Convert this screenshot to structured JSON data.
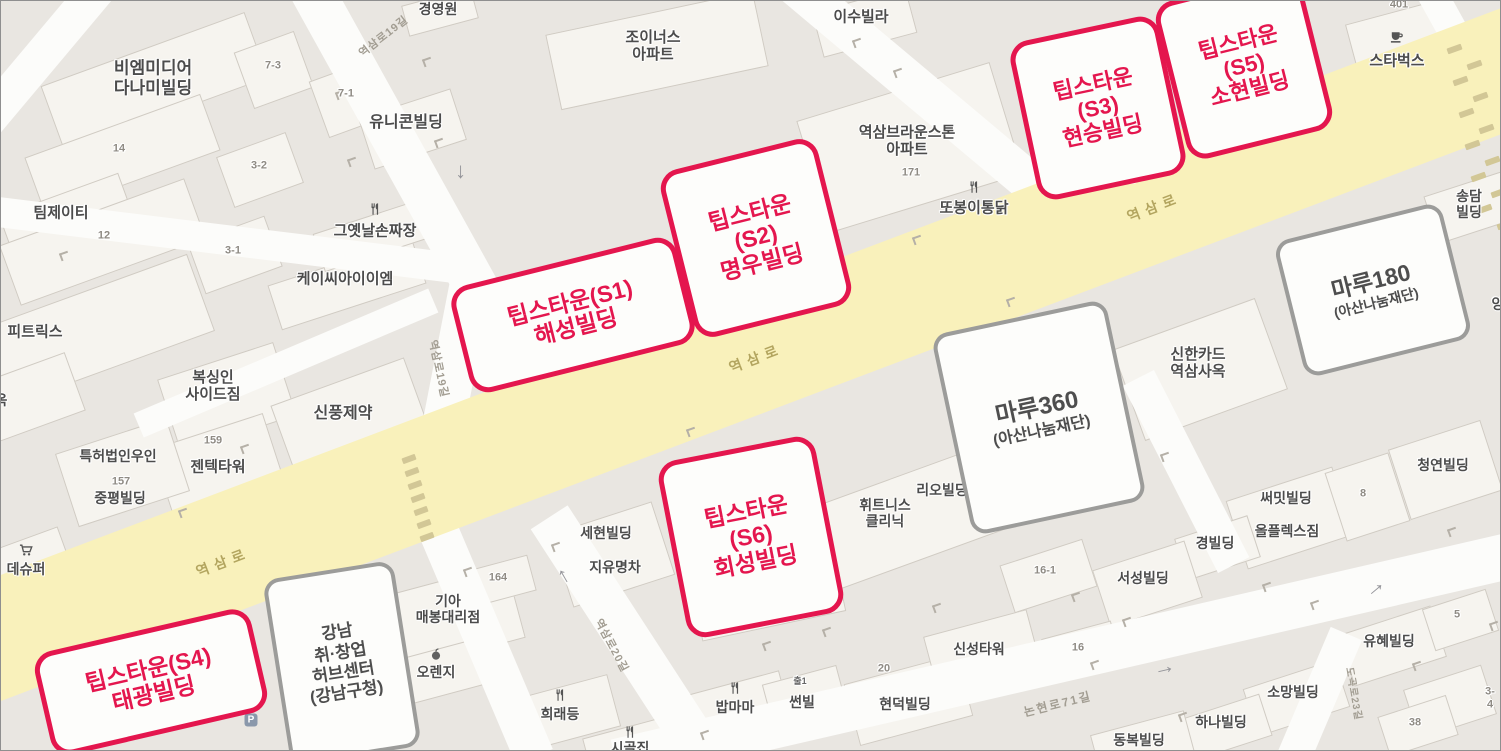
{
  "map": {
    "width": 1501,
    "height": 751,
    "colors": {
      "background": "#e9e6e1",
      "building": "#f6f4ef",
      "road_white": "#fcfcfa",
      "road_yellow": "#f9f1bb",
      "accent_red": "#e4164e",
      "callout_gray_border": "#9c9c9a",
      "label": "#4c4c4c",
      "number": "#8f8b84",
      "main_road_label": "#b3a55f",
      "street_label": "#a29d92"
    }
  },
  "main_road": {
    "x": 725,
    "y": 363,
    "len": 1760,
    "wid": 118,
    "rot": -20.7,
    "name": "yeoksam-ro"
  },
  "roads": [
    {
      "x": 392,
      "y": 137,
      "len": 345,
      "wid": 44,
      "rot": 61
    },
    {
      "x": 451,
      "y": 377,
      "len": 205,
      "wid": 42,
      "rot": 101
    },
    {
      "x": 40,
      "y": 55,
      "len": 175,
      "wid": 36,
      "rot": 130
    },
    {
      "x": 225,
      "y": 239,
      "len": 480,
      "wid": 30,
      "rot": 7
    },
    {
      "x": 285,
      "y": 362,
      "len": 320,
      "wid": 26,
      "rot": -23
    },
    {
      "x": 920,
      "y": 90,
      "len": 330,
      "wid": 40,
      "rot": 40
    },
    {
      "x": 628,
      "y": 640,
      "len": 295,
      "wid": 44,
      "rot": 57
    },
    {
      "x": 485,
      "y": 643,
      "len": 245,
      "wid": 40,
      "rot": 67
    },
    {
      "x": 1065,
      "y": 657,
      "len": 925,
      "wid": 46,
      "rot": -13
    },
    {
      "x": 1318,
      "y": 697,
      "len": 140,
      "wid": 34,
      "rot": 113
    },
    {
      "x": 1449,
      "y": 25,
      "len": 90,
      "wid": 30,
      "rot": 61
    },
    {
      "x": 1185,
      "y": 470,
      "len": 210,
      "wid": 35,
      "rot": 63
    }
  ],
  "buildings": [
    [
      152,
      80,
      215,
      68,
      -20
    ],
    [
      272,
      68,
      62,
      58,
      -20
    ],
    [
      347,
      97,
      62,
      58,
      -20
    ],
    [
      410,
      127,
      95,
      52,
      -18
    ],
    [
      120,
      152,
      185,
      58,
      -20
    ],
    [
      258,
      168,
      72,
      52,
      -20
    ],
    [
      64,
      214,
      125,
      45,
      -20
    ],
    [
      100,
      240,
      195,
      62,
      -20
    ],
    [
      233,
      253,
      80,
      52,
      -20
    ],
    [
      345,
      282,
      150,
      45,
      -18
    ],
    [
      372,
      233,
      115,
      38,
      -18
    ],
    [
      90,
      330,
      230,
      80,
      -20
    ],
    [
      30,
      395,
      90,
      60,
      -20
    ],
    [
      225,
      395,
      120,
      75,
      -18
    ],
    [
      218,
      470,
      115,
      85,
      -18
    ],
    [
      120,
      470,
      115,
      75,
      -18
    ],
    [
      350,
      420,
      140,
      85,
      -20
    ],
    [
      25,
      560,
      80,
      45,
      -20
    ],
    [
      655,
      48,
      210,
      75,
      -12
    ],
    [
      862,
      20,
      95,
      45,
      -15
    ],
    [
      908,
      145,
      200,
      115,
      -17
    ],
    [
      1398,
      42,
      95,
      65,
      -15
    ],
    [
      1470,
      205,
      85,
      48,
      -18
    ],
    [
      1198,
      367,
      150,
      95,
      -20
    ],
    [
      940,
      492,
      85,
      40,
      -20
    ],
    [
      895,
      520,
      200,
      85,
      -20
    ],
    [
      1443,
      468,
      95,
      72,
      -18
    ],
    [
      1288,
      516,
      110,
      70,
      -18
    ],
    [
      1215,
      546,
      75,
      42,
      -18
    ],
    [
      610,
      552,
      105,
      75,
      -18
    ],
    [
      450,
      615,
      130,
      75,
      -15
    ],
    [
      437,
      670,
      85,
      45,
      -15
    ],
    [
      560,
      712,
      105,
      52,
      -15
    ],
    [
      736,
      705,
      95,
      48,
      -15
    ],
    [
      803,
      697,
      75,
      48,
      -15
    ],
    [
      906,
      698,
      115,
      62,
      -15
    ],
    [
      980,
      650,
      105,
      58,
      -15
    ],
    [
      1145,
      582,
      95,
      58,
      -18
    ],
    [
      1046,
      574,
      85,
      48,
      -18
    ],
    [
      1390,
      644,
      95,
      52,
      -18
    ],
    [
      1294,
      696,
      95,
      48,
      -18
    ],
    [
      1222,
      726,
      85,
      42,
      -18
    ],
    [
      1140,
      742,
      95,
      42,
      -15
    ],
    [
      1458,
      618,
      65,
      42,
      -18
    ],
    [
      1365,
      495,
      65,
      70,
      -18
    ],
    [
      1448,
      700,
      80,
      50,
      -18
    ],
    [
      1416,
      724,
      70,
      40,
      -18
    ],
    [
      1080,
      650,
      70,
      45,
      -15
    ],
    [
      500,
      578,
      60,
      35,
      -15
    ],
    [
      755,
      545,
      145,
      160,
      -12
    ],
    [
      630,
      745,
      90,
      40,
      -15
    ],
    [
      438,
      10,
      70,
      30,
      -15
    ]
  ],
  "crosswalks": [
    {
      "x": 408,
      "y": 458,
      "count": 7,
      "dx": 3,
      "dy": 13,
      "w": 14,
      "h": 6,
      "rot": -20
    },
    {
      "x": 1453,
      "y": 48,
      "count": 12,
      "dx": 3,
      "dy": 16,
      "w": 15,
      "h": 6,
      "rot": -20,
      "stagger": 17
    }
  ],
  "entrance_marks": [
    [
      335,
      90
    ],
    [
      422,
      57
    ],
    [
      59,
      251
    ],
    [
      347,
      157
    ],
    [
      434,
      138
    ],
    [
      852,
      38
    ],
    [
      1032,
      47
    ],
    [
      893,
      68
    ],
    [
      240,
      444
    ],
    [
      178,
      508
    ],
    [
      463,
      567
    ],
    [
      551,
      542
    ],
    [
      762,
      641
    ],
    [
      822,
      627
    ],
    [
      932,
      603
    ],
    [
      1122,
      617
    ],
    [
      1071,
      592
    ],
    [
      1262,
      582
    ],
    [
      1412,
      661
    ],
    [
      1489,
      621
    ],
    [
      686,
      427
    ],
    [
      781,
      482
    ],
    [
      1160,
      452
    ],
    [
      1006,
      297
    ],
    [
      1447,
      527
    ],
    [
      912,
      235
    ],
    [
      1090,
      660
    ],
    [
      1310,
      600
    ],
    [
      700,
      730
    ],
    [
      1178,
      712
    ]
  ],
  "road_labels": [
    {
      "t": "역삼로",
      "x": 755,
      "y": 357,
      "rot": -21,
      "s": 14,
      "sp": 6,
      "c": "#b3a55f"
    },
    {
      "t": "역삼로",
      "x": 1153,
      "y": 206,
      "rot": -21,
      "s": 14,
      "sp": 6,
      "c": "#b3a55f"
    },
    {
      "t": "역삼로",
      "x": 222,
      "y": 561,
      "rot": -21,
      "s": 14,
      "sp": 6,
      "c": "#b3a55f"
    },
    {
      "t": "역삼로19길",
      "x": 383,
      "y": 36,
      "rot": -38,
      "s": 11,
      "sp": 1,
      "c": "#a29d92"
    },
    {
      "t": "역삼로19길",
      "x": 437,
      "y": 368,
      "rot": 78,
      "s": 11,
      "sp": 1,
      "c": "#a29d92"
    },
    {
      "t": "역삼로20길",
      "x": 610,
      "y": 645,
      "rot": 62,
      "s": 11,
      "sp": 1,
      "c": "#a29d92"
    },
    {
      "t": "논현로71길",
      "x": 1057,
      "y": 704,
      "rot": -14,
      "s": 12,
      "sp": 2,
      "c": "#a29d92"
    },
    {
      "t": "도곡로23길",
      "x": 1352,
      "y": 693,
      "rot": 80,
      "s": 10,
      "sp": 1,
      "c": "#a29d92"
    }
  ],
  "labels": [
    {
      "t": "비엠미디어\n다나미빌딩",
      "x": 152,
      "y": 77,
      "s": 17
    },
    {
      "t": "유니콘빌딩",
      "x": 405,
      "y": 122,
      "s": 16
    },
    {
      "t": "팀제이티",
      "x": 60,
      "y": 212,
      "s": 15
    },
    {
      "t": "그옛날손짜장",
      "x": 374,
      "y": 230,
      "s": 15,
      "ic": "restaurant",
      "iy": -22
    },
    {
      "t": "케이씨아이이엠",
      "x": 344,
      "y": 278,
      "s": 15
    },
    {
      "t": "경영원",
      "x": 437,
      "y": 8,
      "s": 14
    },
    {
      "t": "조이너스\n아파트",
      "x": 652,
      "y": 45,
      "s": 15
    },
    {
      "t": "이수빌라",
      "x": 860,
      "y": 16,
      "s": 15
    },
    {
      "t": "역삼브라운스톤\n아파트",
      "x": 906,
      "y": 140,
      "s": 15
    },
    {
      "t": "또봉이통닭",
      "x": 973,
      "y": 207,
      "s": 15,
      "ic": "restaurant",
      "iy": -21
    },
    {
      "t": "스타벅스",
      "x": 1396,
      "y": 60,
      "s": 15,
      "ic": "coffee",
      "iy": -24
    },
    {
      "t": "송담빌딩",
      "x": 1468,
      "y": 203,
      "s": 14
    },
    {
      "t": "양",
      "x": 1497,
      "y": 303,
      "s": 14
    },
    {
      "t": "피트릭스",
      "x": 34,
      "y": 331,
      "s": 15
    },
    {
      "t": "옥",
      "x": 0,
      "y": 399,
      "s": 14
    },
    {
      "t": "복싱인\n사이드짐",
      "x": 212,
      "y": 385,
      "s": 15
    },
    {
      "t": "젠텍타워",
      "x": 217,
      "y": 466,
      "s": 15
    },
    {
      "t": "특허법인우인",
      "x": 117,
      "y": 455,
      "s": 14
    },
    {
      "t": "중평빌딩",
      "x": 119,
      "y": 497,
      "s": 14
    },
    {
      "t": "신풍제약",
      "x": 342,
      "y": 413,
      "s": 16
    },
    {
      "t": "데슈퍼",
      "x": 25,
      "y": 568,
      "s": 14,
      "ic": "cart",
      "iy": -19
    },
    {
      "t": "신한카드\n역삼사옥",
      "x": 1197,
      "y": 362,
      "s": 15
    },
    {
      "t": "리오빌딩",
      "x": 941,
      "y": 489,
      "s": 14
    },
    {
      "t": "휘트니스\n클리닉",
      "x": 884,
      "y": 512,
      "s": 14
    },
    {
      "t": "청연빌딩",
      "x": 1442,
      "y": 464,
      "s": 14
    },
    {
      "t": "써밋빌딩",
      "x": 1285,
      "y": 497,
      "s": 14
    },
    {
      "t": "올플렉스짐",
      "x": 1286,
      "y": 530,
      "s": 14
    },
    {
      "t": "경빌딩",
      "x": 1214,
      "y": 542,
      "s": 14
    },
    {
      "t": "세현빌딩",
      "x": 605,
      "y": 532,
      "s": 14
    },
    {
      "t": "지유명차",
      "x": 614,
      "y": 566,
      "s": 14
    },
    {
      "t": "기아\n매봉대리점",
      "x": 447,
      "y": 608,
      "s": 14
    },
    {
      "t": "오렌지",
      "x": 435,
      "y": 671,
      "s": 14,
      "ic": "orange",
      "iy": -18
    },
    {
      "t": "희래등",
      "x": 559,
      "y": 713,
      "s": 14,
      "ic": "restaurant",
      "iy": -19
    },
    {
      "t": "밥마마",
      "x": 734,
      "y": 706,
      "s": 14,
      "ic": "restaurant",
      "iy": -19
    },
    {
      "t": "썬빌",
      "x": 801,
      "y": 701,
      "s": 14
    },
    {
      "t": "출1",
      "x": 799,
      "y": 680,
      "s": 9,
      "c": "#666666"
    },
    {
      "t": "현덕빌딩",
      "x": 904,
      "y": 703,
      "s": 14
    },
    {
      "t": "신성타워",
      "x": 978,
      "y": 648,
      "s": 14
    },
    {
      "t": "서성빌딩",
      "x": 1142,
      "y": 577,
      "s": 14
    },
    {
      "t": "유혜빌딩",
      "x": 1388,
      "y": 640,
      "s": 14
    },
    {
      "t": "소망빌딩",
      "x": 1292,
      "y": 691,
      "s": 14
    },
    {
      "t": "하나빌딩",
      "x": 1220,
      "y": 721,
      "s": 14
    },
    {
      "t": "동복빌딩",
      "x": 1138,
      "y": 739,
      "s": 14
    },
    {
      "t": "시골집",
      "x": 629,
      "y": 747,
      "s": 14,
      "ic": "restaurant",
      "iy": -16
    },
    {
      "t": "K",
      "x": 1041,
      "y": 173,
      "s": 13,
      "c": "#3c3c3c"
    },
    {
      "t": "은행",
      "x": 1124,
      "y": 177,
      "s": 13,
      "c": "#3c3c3c"
    }
  ],
  "numbers": [
    {
      "t": "7-3",
      "x": 272,
      "y": 65
    },
    {
      "t": "7-1",
      "x": 345,
      "y": 93
    },
    {
      "t": "14",
      "x": 118,
      "y": 148
    },
    {
      "t": "3-2",
      "x": 258,
      "y": 165
    },
    {
      "t": "12",
      "x": 103,
      "y": 235
    },
    {
      "t": "3-1",
      "x": 232,
      "y": 250
    },
    {
      "t": "171",
      "x": 910,
      "y": 172
    },
    {
      "t": "159",
      "x": 212,
      "y": 440
    },
    {
      "t": "157",
      "x": 120,
      "y": 481
    },
    {
      "t": "164",
      "x": 497,
      "y": 577
    },
    {
      "t": "401",
      "x": 1398,
      "y": 4
    },
    {
      "t": "16-1",
      "x": 1044,
      "y": 570
    },
    {
      "t": "16",
      "x": 1077,
      "y": 647
    },
    {
      "t": "20",
      "x": 883,
      "y": 668
    },
    {
      "t": "8",
      "x": 1362,
      "y": 493
    },
    {
      "t": "5",
      "x": 1456,
      "y": 614
    },
    {
      "t": "38",
      "x": 1414,
      "y": 722
    },
    {
      "t": "3-4",
      "x": 1489,
      "y": 697
    }
  ],
  "arrows": [
    {
      "x": 463,
      "y": 171,
      "rot": 90
    },
    {
      "x": 560,
      "y": 577,
      "rot": -120
    },
    {
      "x": 1163,
      "y": 666,
      "rot": -13
    },
    {
      "x": 1373,
      "y": 586,
      "rot": -40
    }
  ],
  "badges": [
    {
      "t": "P",
      "x": 250,
      "y": 719
    }
  ],
  "callouts_red": [
    {
      "id": "tips-s1",
      "text": "팁스타운(S1)\n해성빌딩",
      "x": 572,
      "y": 314,
      "w": 232,
      "h": 110,
      "rot": -14,
      "s": 23
    },
    {
      "id": "tips-s2",
      "text": "팁스타운\n(S2)\n명우빌딩",
      "x": 755,
      "y": 237,
      "w": 162,
      "h": 172,
      "rot": -14,
      "s": 23
    },
    {
      "id": "tips-s3",
      "text": "팁스타운\n(S3)\n현승빌딩",
      "x": 1097,
      "y": 107,
      "w": 152,
      "h": 162,
      "rot": -12,
      "s": 22
    },
    {
      "id": "tips-s5",
      "text": "팁스타운\n(S5)\n소현빌딩",
      "x": 1243,
      "y": 65,
      "w": 150,
      "h": 162,
      "rot": -14,
      "s": 22
    },
    {
      "id": "tips-s4",
      "text": "팁스타운(S4)\n태광빌딩",
      "x": 150,
      "y": 681,
      "w": 222,
      "h": 106,
      "rot": -13,
      "s": 23
    },
    {
      "id": "tips-s6",
      "text": "팁스타운\n(S6)\n회성빌딩",
      "x": 750,
      "y": 536,
      "w": 160,
      "h": 180,
      "rot": -11,
      "s": 23
    }
  ],
  "callouts_gray": [
    {
      "id": "maru180",
      "x": 1372,
      "y": 289,
      "w": 172,
      "h": 140,
      "rot": -14,
      "lines": [
        {
          "t": "마루180",
          "s": 23
        },
        {
          "t": "(아산나눔재단)",
          "s": 14
        }
      ]
    },
    {
      "id": "maru360",
      "x": 1038,
      "y": 416,
      "w": 178,
      "h": 205,
      "rot": -12,
      "lines": [
        {
          "t": "마루360",
          "s": 24
        },
        {
          "t": "(아산나눔재단)",
          "s": 16
        }
      ]
    },
    {
      "id": "gangnam-hub",
      "x": 341,
      "y": 662,
      "w": 132,
      "h": 188,
      "rot": -9,
      "lines": [
        {
          "t": "강남",
          "s": 17
        },
        {
          "t": "취·창업",
          "s": 17
        },
        {
          "t": "허브센터",
          "s": 17
        },
        {
          "t": "(강남구청)",
          "s": 17
        }
      ]
    }
  ]
}
